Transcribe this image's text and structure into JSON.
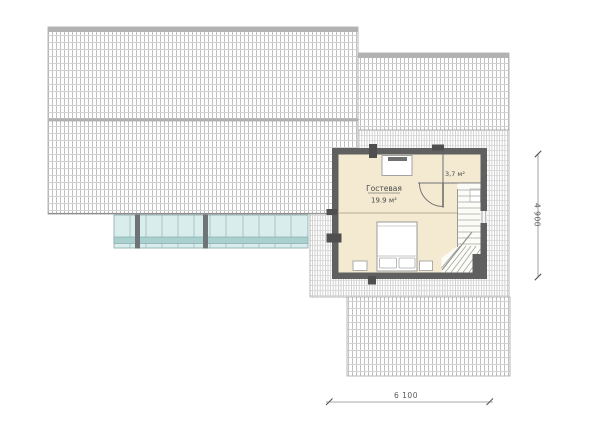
{
  "plan": {
    "title": "attic-floor-roof-plan",
    "rooms": {
      "guest": {
        "name": "Гостевая",
        "area": "19.9 м²"
      },
      "small": {
        "area": "3,7 м²"
      }
    },
    "dimensions": {
      "bottom_width": "6 100",
      "right_height": "4 900"
    },
    "colors": {
      "floor": "#f4ead2",
      "wall": "#606060",
      "glass": "#d8edec",
      "glass_stripe": "#a9cfcf",
      "glass_post": "#6e7476",
      "roof_edge": "#a9a9a9"
    }
  }
}
